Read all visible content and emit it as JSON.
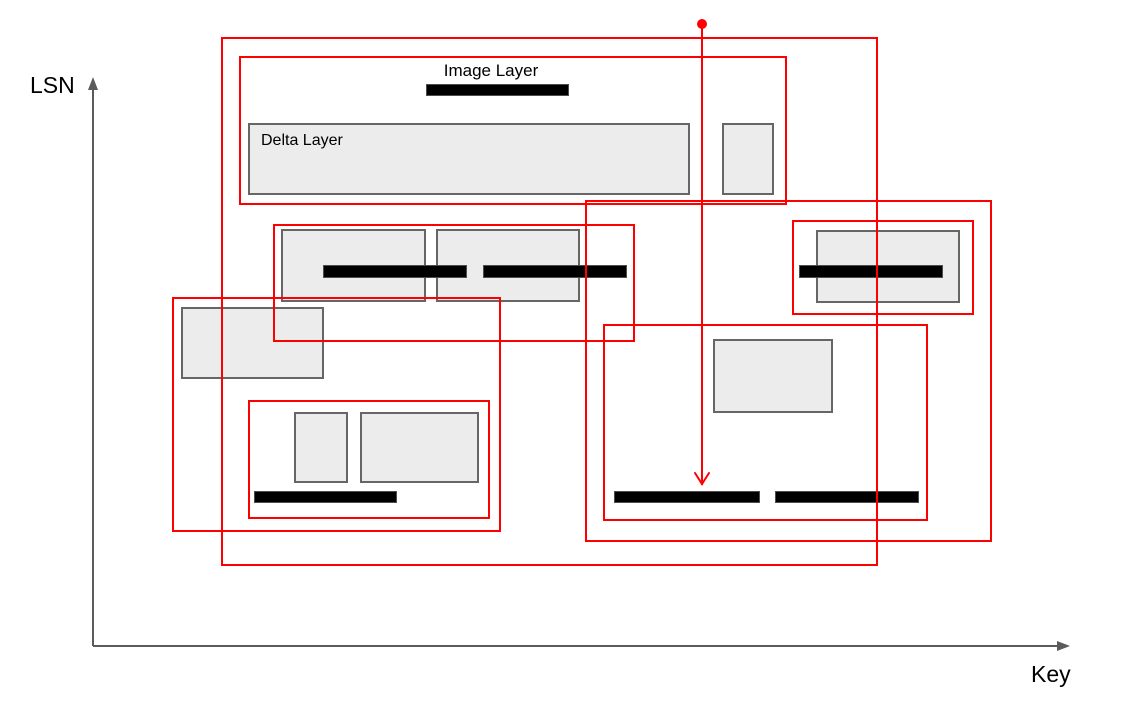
{
  "diagram": {
    "y_axis_label": "LSN",
    "x_axis_label": "Key",
    "image_layer_label": "Image Layer",
    "delta_layer_label": "Delta Layer",
    "colors": {
      "highlight": "#FF0000",
      "layer_fill": "#ECECEC",
      "layer_border": "#666666",
      "image_bar": "#000000",
      "axis": "#5B5B5B"
    }
  }
}
